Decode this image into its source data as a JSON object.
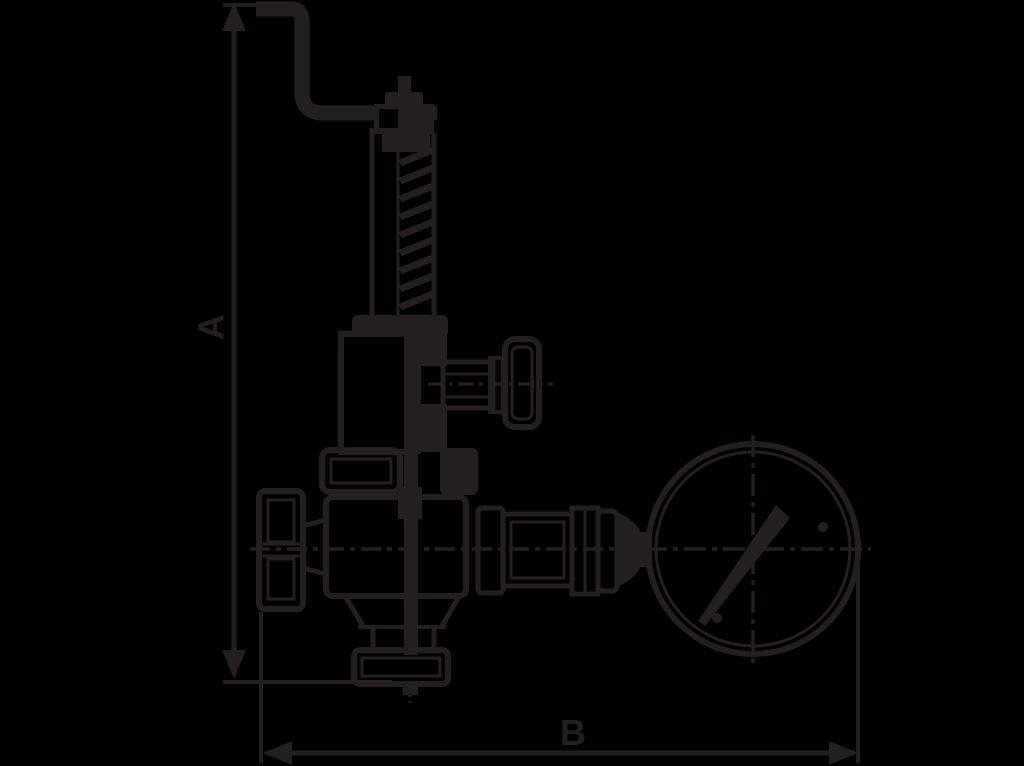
{
  "page": {
    "background_color": "#000000"
  },
  "drawing": {
    "type": "technical-line-drawing",
    "subject": "Spring-loaded safety relief valve with lifting lever and pressure gauge",
    "line_color": "#231f20",
    "dimension_a": {
      "label": "A",
      "orientation": "vertical"
    },
    "dimension_b": {
      "label": "B",
      "orientation": "horizontal"
    },
    "components": {
      "lever": "lifting-lever",
      "adjusting_cap": "adjusting-cap",
      "spring": "spring-housing-coil",
      "bonnet": "bonnet",
      "test_knob": "side-test-knob",
      "union": "union-nut",
      "body": "valve-body",
      "inlet_cap": "inlet-cap",
      "flange": "bottom-outlet-flange",
      "fittings": "outlet-fittings",
      "gauge": "pressure-gauge",
      "needle": "gauge-needle"
    }
  }
}
